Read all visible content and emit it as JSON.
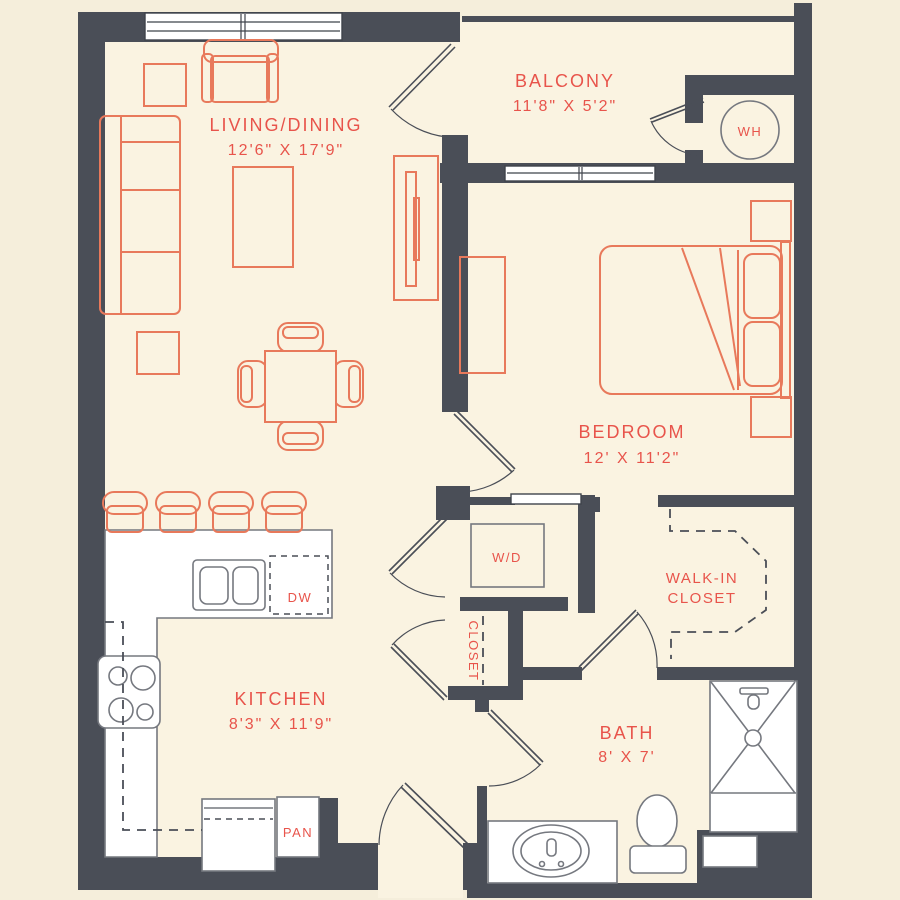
{
  "colors": {
    "wall": "#4a4e57",
    "floor": "#faf3e1",
    "outer": "#f5eedb",
    "furn": "#e8795b",
    "accent_red": "#e8544b",
    "fixgray": "#75787f"
  },
  "rooms": {
    "living": {
      "name": "LIVING/DINING",
      "dims": "12'6\" X 17'9\""
    },
    "balcony": {
      "name": "BALCONY",
      "dims": "11'8\" X 5'2\""
    },
    "bedroom": {
      "name": "BEDROOM",
      "dims": "12' X 11'2\""
    },
    "kitchen": {
      "name": "KITCHEN",
      "dims": "8'3\" X 11'9\""
    },
    "bath": {
      "name": "BATH",
      "dims": "8' X 7'"
    },
    "walk_in_closet": {
      "line1": "WALK-IN",
      "line2": "CLOSET"
    },
    "closet": {
      "name": "CLOSET"
    }
  },
  "fixtures": {
    "water_heater": "WH",
    "washer_dryer": "W/D",
    "dishwasher": "DW",
    "pantry": "PAN"
  }
}
